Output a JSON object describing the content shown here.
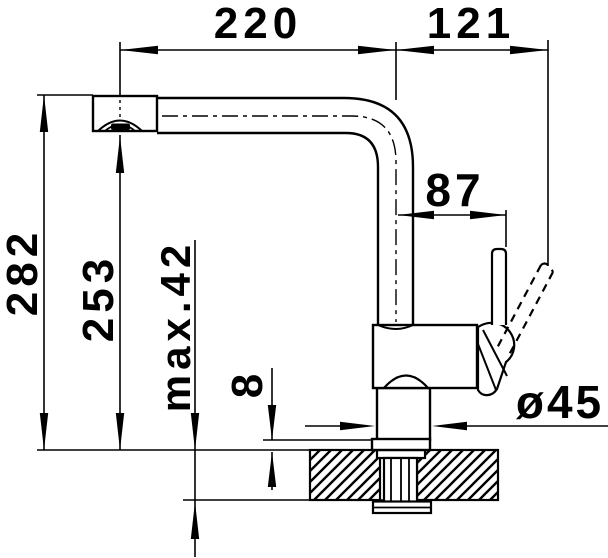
{
  "meta": {
    "description": "Technical dimension drawing, single-lever kitchen mixer tap, side view",
    "colors": {
      "line": "#000000",
      "background": "#ffffff"
    }
  },
  "dims": {
    "spout_reach": "220",
    "handle_span": "121",
    "handle_offset": "87",
    "overall_height": "282",
    "outlet_height": "253",
    "max_deck_thickness": "max.42",
    "base_plate_height": "8",
    "base_diameter": "ø45"
  }
}
